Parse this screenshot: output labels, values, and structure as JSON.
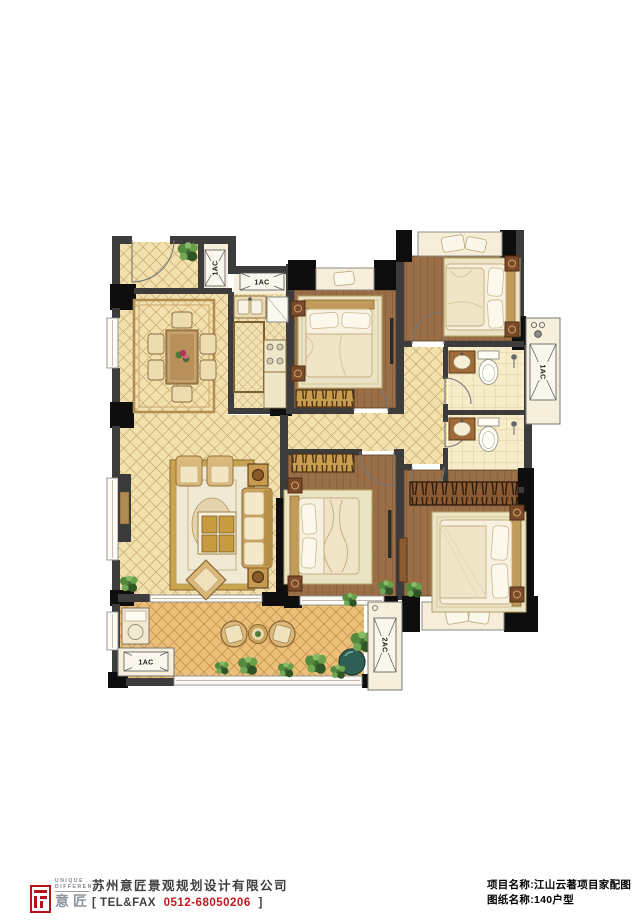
{
  "plan": {
    "ac_labels": [
      {
        "text": "1AC"
      },
      {
        "text": "1AC"
      },
      {
        "text": "1AC"
      },
      {
        "text": "1AC"
      },
      {
        "text": "2AC"
      }
    ]
  },
  "footer": {
    "logo": {
      "line1": "UNIQUE",
      "line2": "DIFFERENT",
      "brand": "意匠"
    },
    "company_name": "苏州意匠景观规划设计有限公司",
    "tel_open": "[",
    "tel_label": "TEL&FAX",
    "tel_number": "0512-68050206",
    "tel_close": "]",
    "project_line": "项目名称:江山云著项目家配图",
    "sheet_line": "图纸名称:140户型"
  },
  "colors": {
    "accent_red": "#c0181f",
    "wall_dark": "#3c3c3c",
    "tile_beige": "#f2e0ad",
    "wood_brown": "#9a6f47",
    "balcony_tile": "#ecbf78",
    "bath_tile": "#f7ecca"
  }
}
